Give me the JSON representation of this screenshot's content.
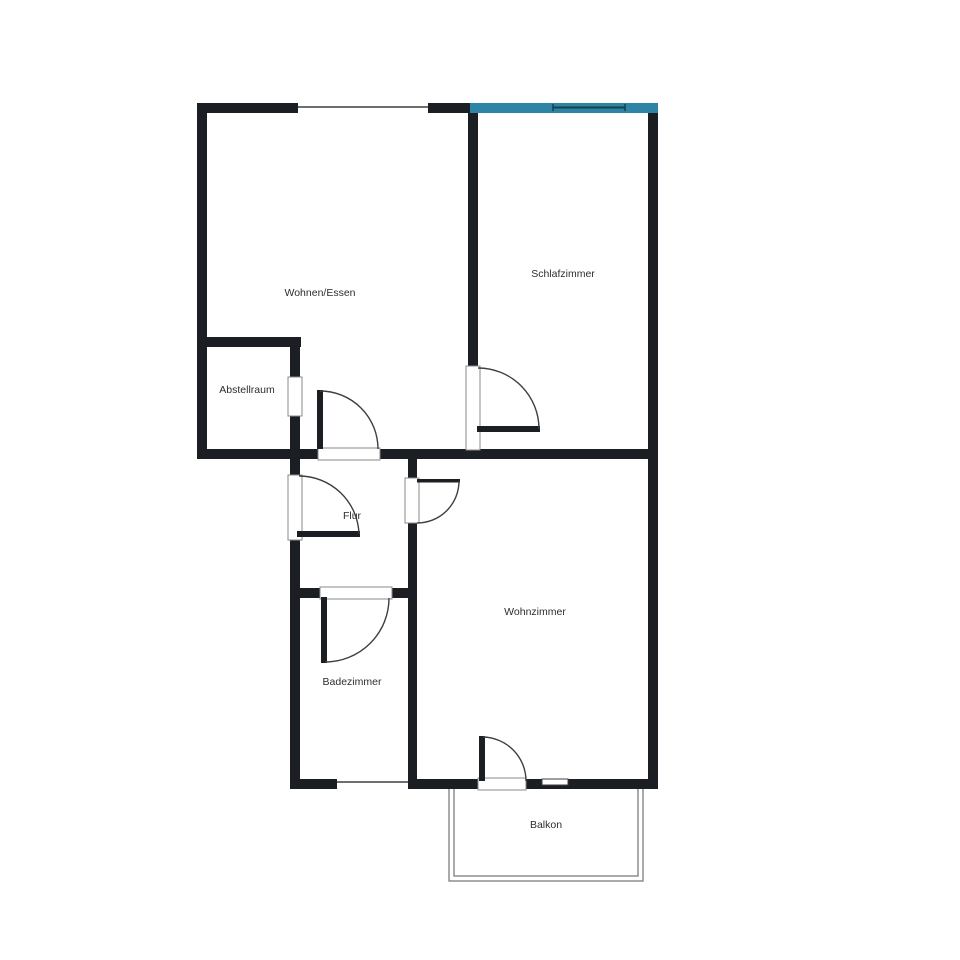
{
  "floor_plan": {
    "rooms": [
      {
        "id": "wohnen-essen",
        "label": "Wohnen/Essen"
      },
      {
        "id": "schlafzimmer",
        "label": "Schlafzimmer"
      },
      {
        "id": "abstellraum",
        "label": "Abstellraum"
      },
      {
        "id": "flur",
        "label": "Flur"
      },
      {
        "id": "badezimmer",
        "label": "Badezimmer"
      },
      {
        "id": "wohnzimmer",
        "label": "Wohnzimmer"
      },
      {
        "id": "balkon",
        "label": "Balkon"
      }
    ],
    "doors": [
      "entrance-door",
      "wohnen-essen-door",
      "schlafzimmer-door",
      "wohnzimmer-door",
      "badezimmer-door",
      "balkon-door",
      "abstellraum-opening"
    ],
    "windows": [
      "wohnen-essen-window",
      "schlafzimmer-window-highlighted",
      "badezimmer-window",
      "wohnzimmer-small-window"
    ]
  },
  "colors": {
    "wall": "#1b1e22",
    "accent": "#2e84a4",
    "accent-dark": "#16414f",
    "line": "#3f3f3f",
    "jamb": "#8a8a8a",
    "balcony": "#7d7d7d",
    "label": "#2d2d2d"
  }
}
